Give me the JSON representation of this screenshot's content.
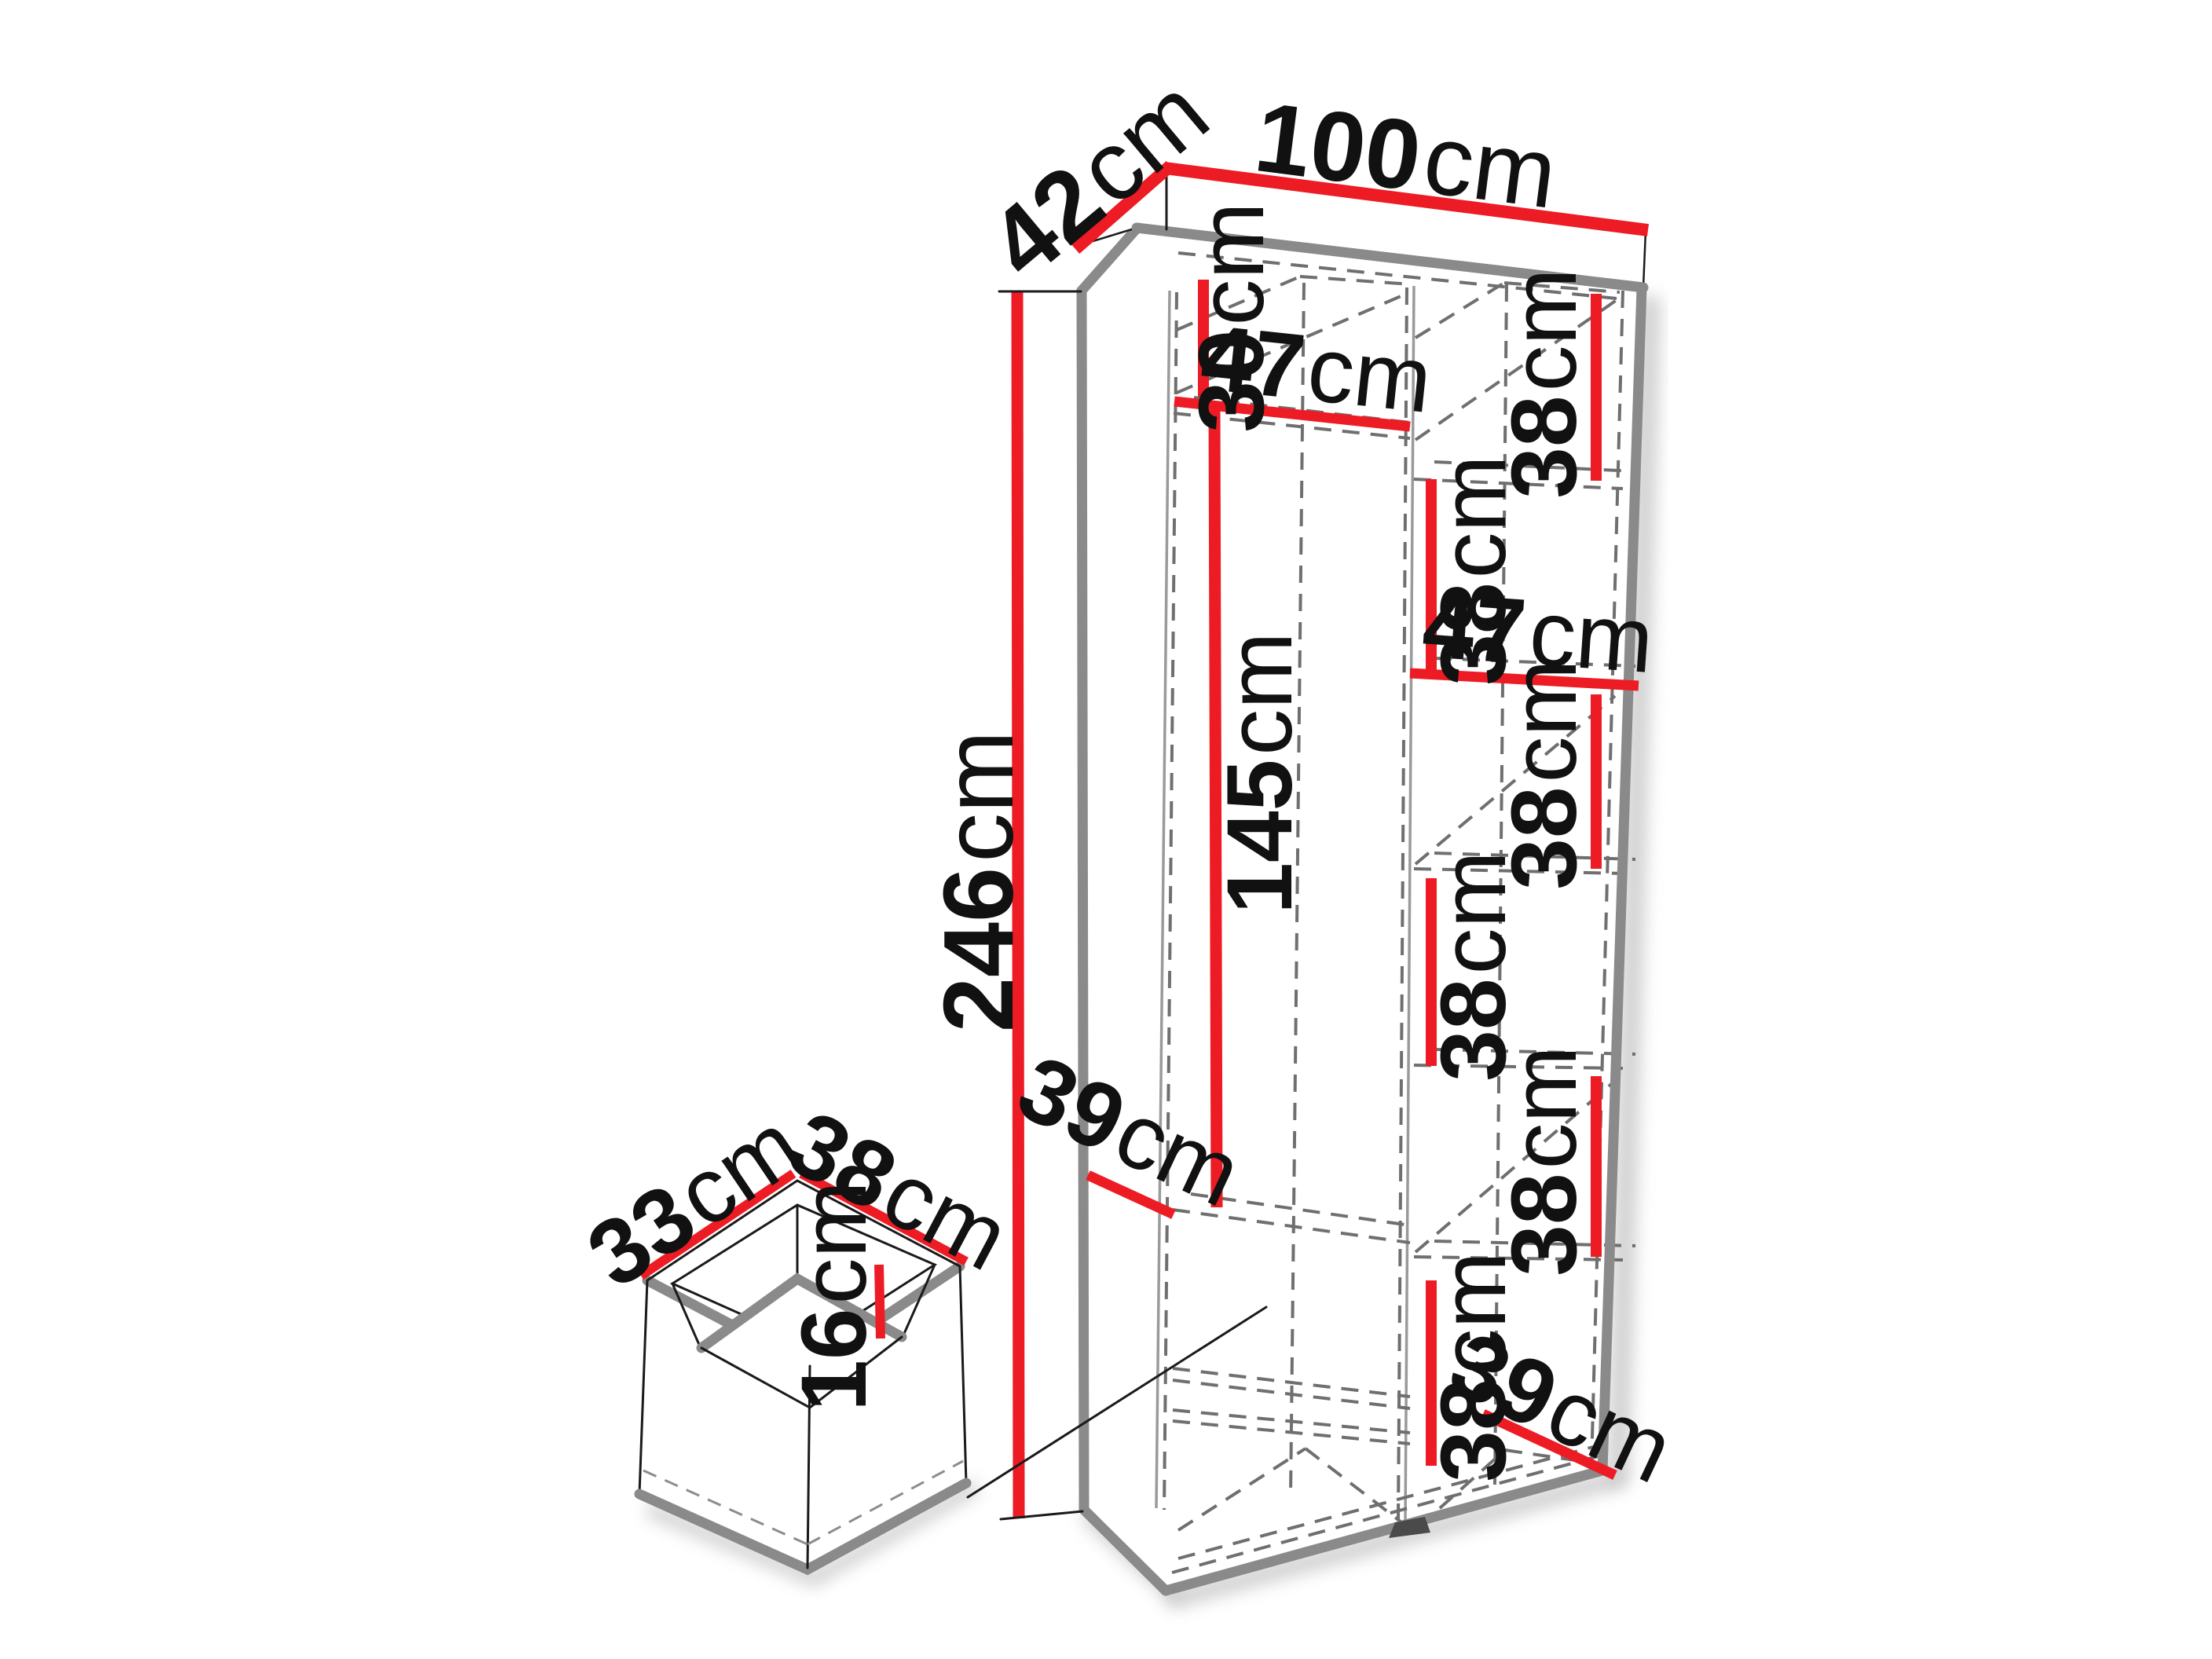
{
  "diagram": {
    "kind": "wardrobe-dimension-drawing",
    "unit": "cm",
    "colors": {
      "dimension_red": "#ed1c24",
      "edge_gray": "#8a8a8a",
      "dash_gray": "#6f6f6f",
      "text_black": "#111111",
      "background": "#ffffff"
    },
    "wardrobe": {
      "width": "100",
      "depth": "42",
      "height": "246",
      "top_compartment_height": "30",
      "left_shelf_width": "47",
      "hanging_section_height": "145",
      "left_shelf_depth": "39",
      "right_shelf_width": "47",
      "right_compartment_heights": [
        "38",
        "38",
        "38",
        "38",
        "38",
        "38"
      ],
      "bottom_shelf_depth": "39"
    },
    "drawer": {
      "depth": "33",
      "width": "38",
      "inner_height": "16"
    }
  }
}
